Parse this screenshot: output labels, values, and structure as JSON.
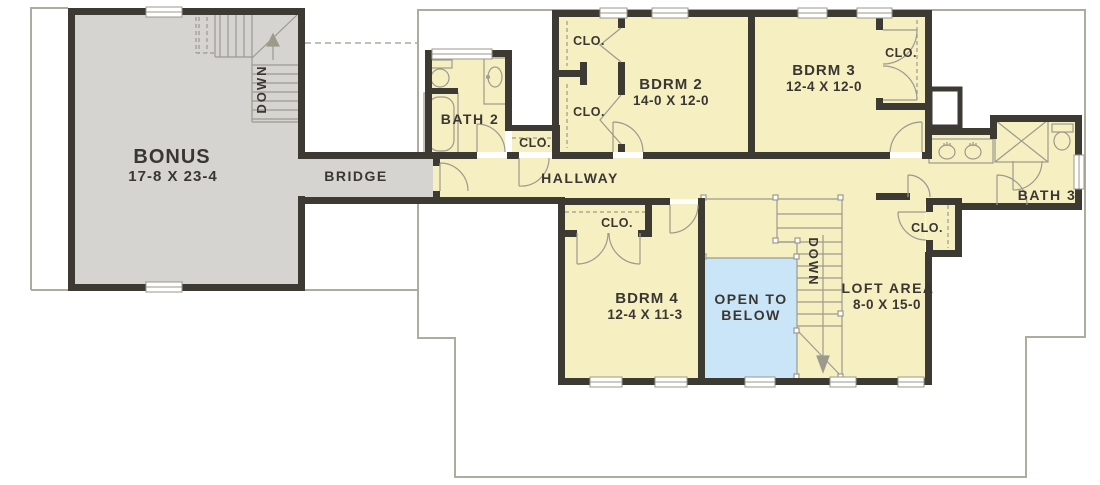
{
  "colors": {
    "floor_yellow": "#f5efc2",
    "floor_gray": "#d5d4d0",
    "open_blue": "#c9e5f7",
    "wall": "#3d3a33",
    "line": "#9b9889",
    "fixture": "#9c9a8d",
    "roof": "#aeac9e",
    "text": "#3a3732",
    "window": "#ffffff"
  },
  "rooms": {
    "bonus": {
      "name": "BONUS",
      "dims": "17-8 X 23-4"
    },
    "bridge": {
      "name": "BRIDGE"
    },
    "bath2": {
      "name": "BATH 2"
    },
    "bdrm2": {
      "name": "BDRM 2",
      "dims": "14-0 X 12-0"
    },
    "bdrm3": {
      "name": "BDRM 3",
      "dims": "12-4 X 12-0"
    },
    "bdrm4": {
      "name": "BDRM 4",
      "dims": "12-4 X 11-3"
    },
    "bath3": {
      "name": "BATH 3"
    },
    "hallway": {
      "name": "HALLWAY"
    },
    "loft": {
      "name": "LOFT AREA",
      "dims": "8-0 X 15-0"
    },
    "open_to_below": {
      "line1": "OPEN TO",
      "line2": "BELOW"
    }
  },
  "labels": {
    "closet": "CLO.",
    "stair_down": "DOWN"
  }
}
